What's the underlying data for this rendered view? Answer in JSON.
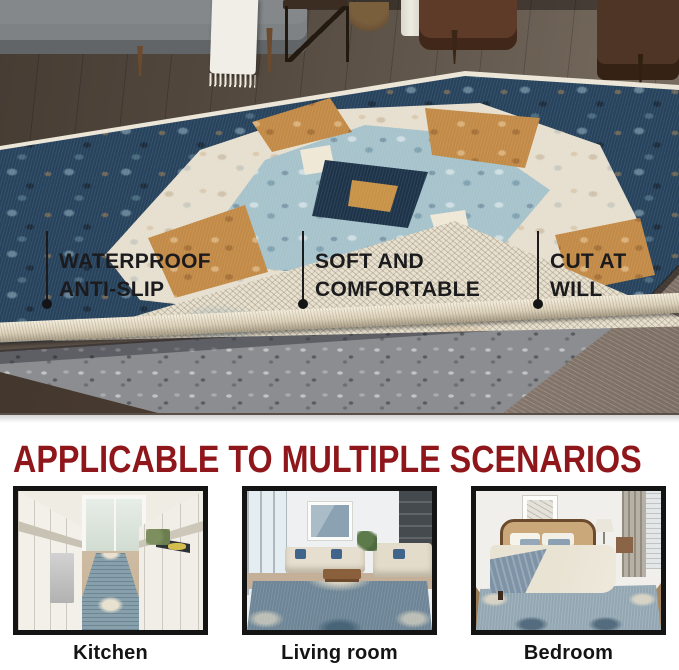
{
  "hero": {
    "callouts": [
      {
        "line1": "WATERPROOF",
        "line2": "ANTI-SLIP"
      },
      {
        "line1": "SOFT AND",
        "line2": "COMFORTABLE"
      },
      {
        "line1": "CUT AT",
        "line2": "WILL"
      }
    ]
  },
  "scenarios": {
    "heading": "APPLICABLE TO MULTIPLE SCENARIOS",
    "items": [
      {
        "label": "Kitchen"
      },
      {
        "label": "Living room"
      },
      {
        "label": "Bedroom"
      }
    ]
  },
  "colors": {
    "heading_red": "#8f171b",
    "callout_text": "#1b1b1d",
    "callout_marker": "#141416",
    "thumbnail_frame": "#141414",
    "label_text": "#141414",
    "rug_navy": "#26425c",
    "rug_light_blue": "#a6c2cb",
    "rug_cream": "#e6dfcf",
    "rug_rust": "#c28a46",
    "rug_pad_gray": "#8b8d91",
    "background": "#ffffff"
  }
}
